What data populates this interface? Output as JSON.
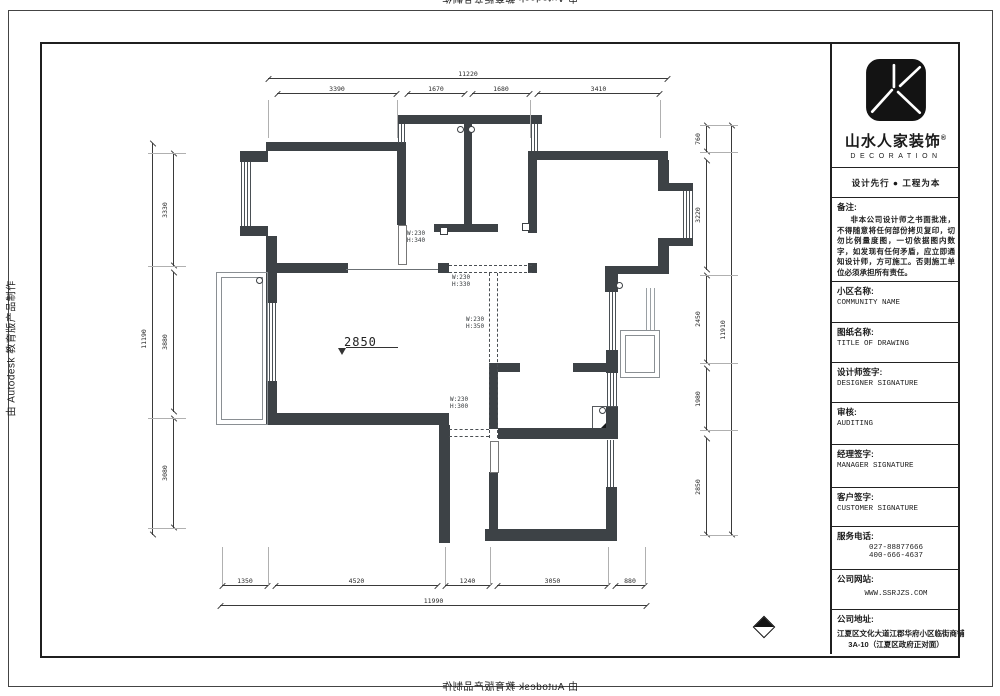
{
  "edge_stamps": {
    "top": "由 Autodesk 教育版产品制作",
    "left": "由 Autodesk 教育版产品制作",
    "bottom": "由 Autodesk 教育版产品制作"
  },
  "title_block": {
    "company_name": "山水人家装饰",
    "registered_mark": "®",
    "company_sub": "DECORATION",
    "slogan": "设计先行 ● 工程为本",
    "notes_label": "备注:",
    "notes_text": "非本公司设计师之书面批准，不得随意将任何部份拷贝复印，切勿比例量度图，一切依据图内数字，如发现有任何矛盾，应立即通知设计师，方可施工。否则施工单位必须承担所有责任。",
    "fields": [
      {
        "label": "小区名称:",
        "value": "COMMUNITY NAME"
      },
      {
        "label": "图纸名称:",
        "value": "TITLE OF DRAWING"
      },
      {
        "label": "设计师签字:",
        "value": "DESIGNER SIGNATURE"
      },
      {
        "label": "审核:",
        "value": "AUDITING"
      },
      {
        "label": "经理签字:",
        "value": "MANAGER SIGNATURE"
      },
      {
        "label": "客户签字:",
        "value": "CUSTOMER SIGNATURE"
      }
    ],
    "phone_label": "服务电话:",
    "phone1": "027-88877666",
    "phone2": "400-666-4637",
    "website_label": "公司网站:",
    "website": "WWW.SSRJZS.COM",
    "address_label": "公司地址:",
    "address_line1": "江夏区文化大道江郡华府小区临街商铺",
    "address_line2": "3A-10（江夏区政府正对面）"
  },
  "plan": {
    "level_label": "2850",
    "opening_labels": [
      {
        "w": "W:230",
        "h": "H:340"
      },
      {
        "w": "W:230",
        "h": "H:330"
      },
      {
        "w": "W:230",
        "h": "H:350"
      },
      {
        "w": "W:230",
        "h": "H:300"
      }
    ],
    "dimensions": {
      "top": {
        "overall": "11220",
        "segments": [
          "3390",
          "1670",
          "1680",
          "3410"
        ]
      },
      "bottom": {
        "overall": "11990",
        "segments": [
          "1350",
          "4520",
          "1240",
          "3050",
          "880"
        ]
      },
      "left": {
        "overall": "11190",
        "segments": [
          "3330",
          "3880",
          "3080"
        ]
      },
      "right": {
        "overall": "11910",
        "segments": [
          "760",
          "3220",
          "2450",
          "1980",
          "2850"
        ]
      }
    }
  }
}
